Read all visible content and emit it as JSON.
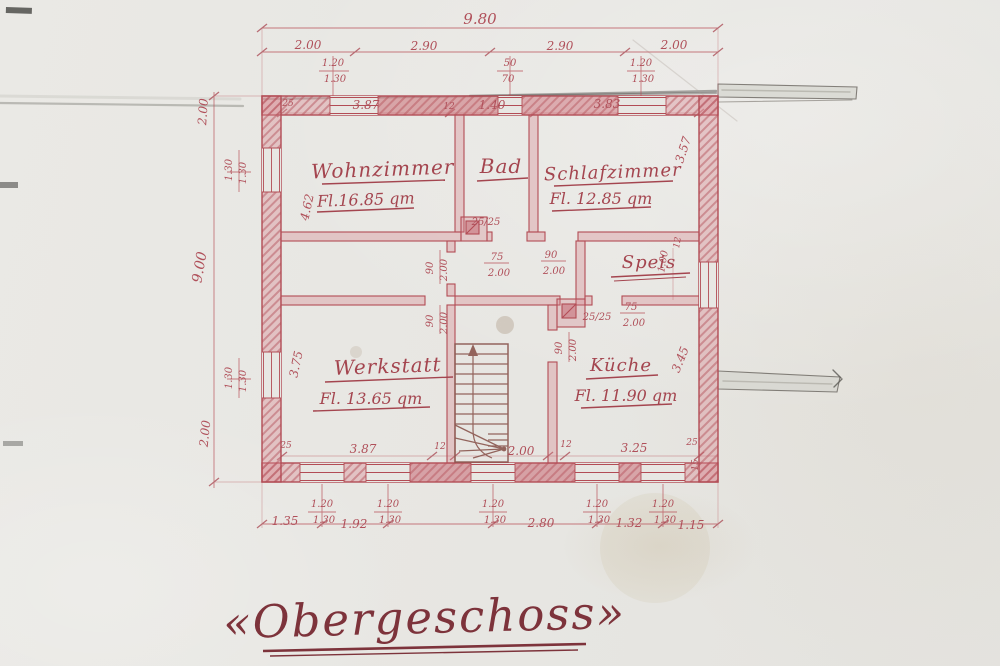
{
  "title": {
    "text": "«Obergeschoss»"
  },
  "rooms": {
    "wohnzimmer": {
      "name": "Wohnzimmer",
      "area": "Fl.16.85 qm"
    },
    "bad": {
      "name": "Bad"
    },
    "schlafzimmer": {
      "name": "Schlafzimmer",
      "area": "Fl. 12.85 qm"
    },
    "speis": {
      "name": "Speis"
    },
    "werkstatt": {
      "name": "Werkstatt",
      "area": "Fl. 13.65 qm"
    },
    "kueche": {
      "name": "Küche",
      "area": "Fl. 11.90 qm"
    }
  },
  "dims": {
    "d980": "9.80",
    "d900": "9.00",
    "d200": "2.00",
    "d290": "2.90",
    "d120": "1.20",
    "d130": "1.30",
    "d50": "50",
    "d70": "70",
    "d25": "25",
    "d15": "15",
    "d12": "12",
    "d2525": "25/25",
    "d75": "75",
    "d90": "90",
    "d387": "3.87",
    "d140": "1.40",
    "d383": "3.83",
    "d462": "4.62",
    "d375": "3.75",
    "d357": "3.57",
    "d345": "3.45",
    "d100": "1.00",
    "d325": "3.25",
    "d135": "1.35",
    "d192": "1.92",
    "d280": "2.80",
    "d132": "1.32",
    "d115": "1.15"
  },
  "colors": {
    "ink": "#b0505a",
    "wall": "#b24c55",
    "pencil": "#8b8b84",
    "title_ink": "#7d333b",
    "paper": "#e8e7e3"
  }
}
